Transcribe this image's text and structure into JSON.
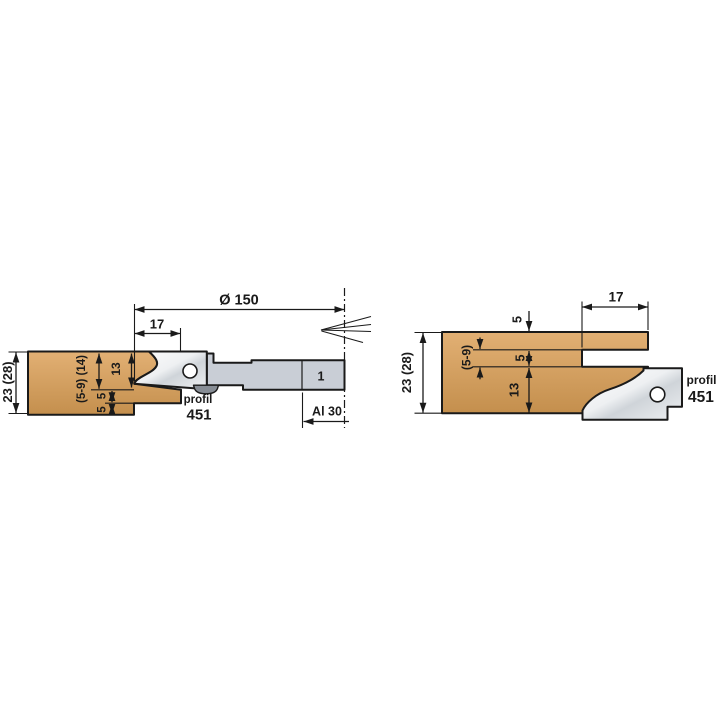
{
  "left_diagram": {
    "dim_diameter": "Ø 150",
    "dim_tenon_length": "17",
    "dim_height": "23 (28)",
    "dim_variable": "(5-9) (14)",
    "dim_top_depth": "13",
    "dim_step_a": "5",
    "dim_step_b": "5",
    "profile_word": "profil",
    "profile_number": "451",
    "dim_bore": "Al 30",
    "spacer_label": "1"
  },
  "right_diagram": {
    "dim_slot_depth": "17",
    "dim_lip": "5",
    "dim_variable": "(5-9)",
    "dim_slot_height": "5",
    "dim_bottom_depth": "13",
    "dim_height": "23 (28)",
    "profile_word": "profil",
    "profile_number": "451"
  },
  "colors": {
    "wood_light": "#e2b074",
    "wood_dark": "#c48f4d",
    "steel_body": "#c9ced6",
    "knife_light": "#fdfdfd",
    "knife_mid": "#eef0f2",
    "knife_shade": "#cfd4d9",
    "screw": "#878d95",
    "outline": "#1a1a1a",
    "background": "#ffffff"
  }
}
